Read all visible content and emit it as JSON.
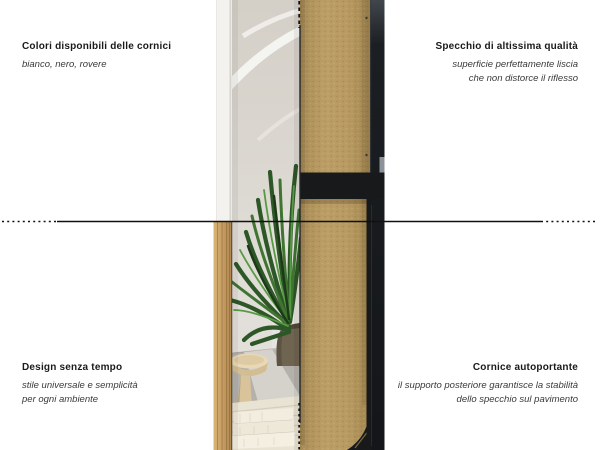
{
  "colors": {
    "background": "#ffffff",
    "text_primary": "#1a1a1a",
    "text_secondary": "#3a3a3a",
    "line_black": "#111111",
    "frame_black": "#17191b",
    "mdf_tan": "#b4975f",
    "oak_frame": "#c49a60",
    "white_frame": "#f3f2ef",
    "plant_green": "#3a7030"
  },
  "annotations": {
    "top_left": {
      "title": "Colori disponibili delle cornici",
      "lines": [
        "bianco, nero, rovere"
      ]
    },
    "top_right": {
      "title": "Specchio di altissima qualità",
      "lines": [
        "superficie perfettamente liscia",
        "che non distorce il riflesso"
      ]
    },
    "bottom_left": {
      "title": "Design senza tempo",
      "lines": [
        "stile universale e semplicità",
        "per ogni ambiente"
      ]
    },
    "bottom_right": {
      "title": "Cornice autoportante",
      "lines": [
        "il supporto posteriore garantisce la stabilità",
        "dello specchio sul pavimento"
      ]
    }
  }
}
